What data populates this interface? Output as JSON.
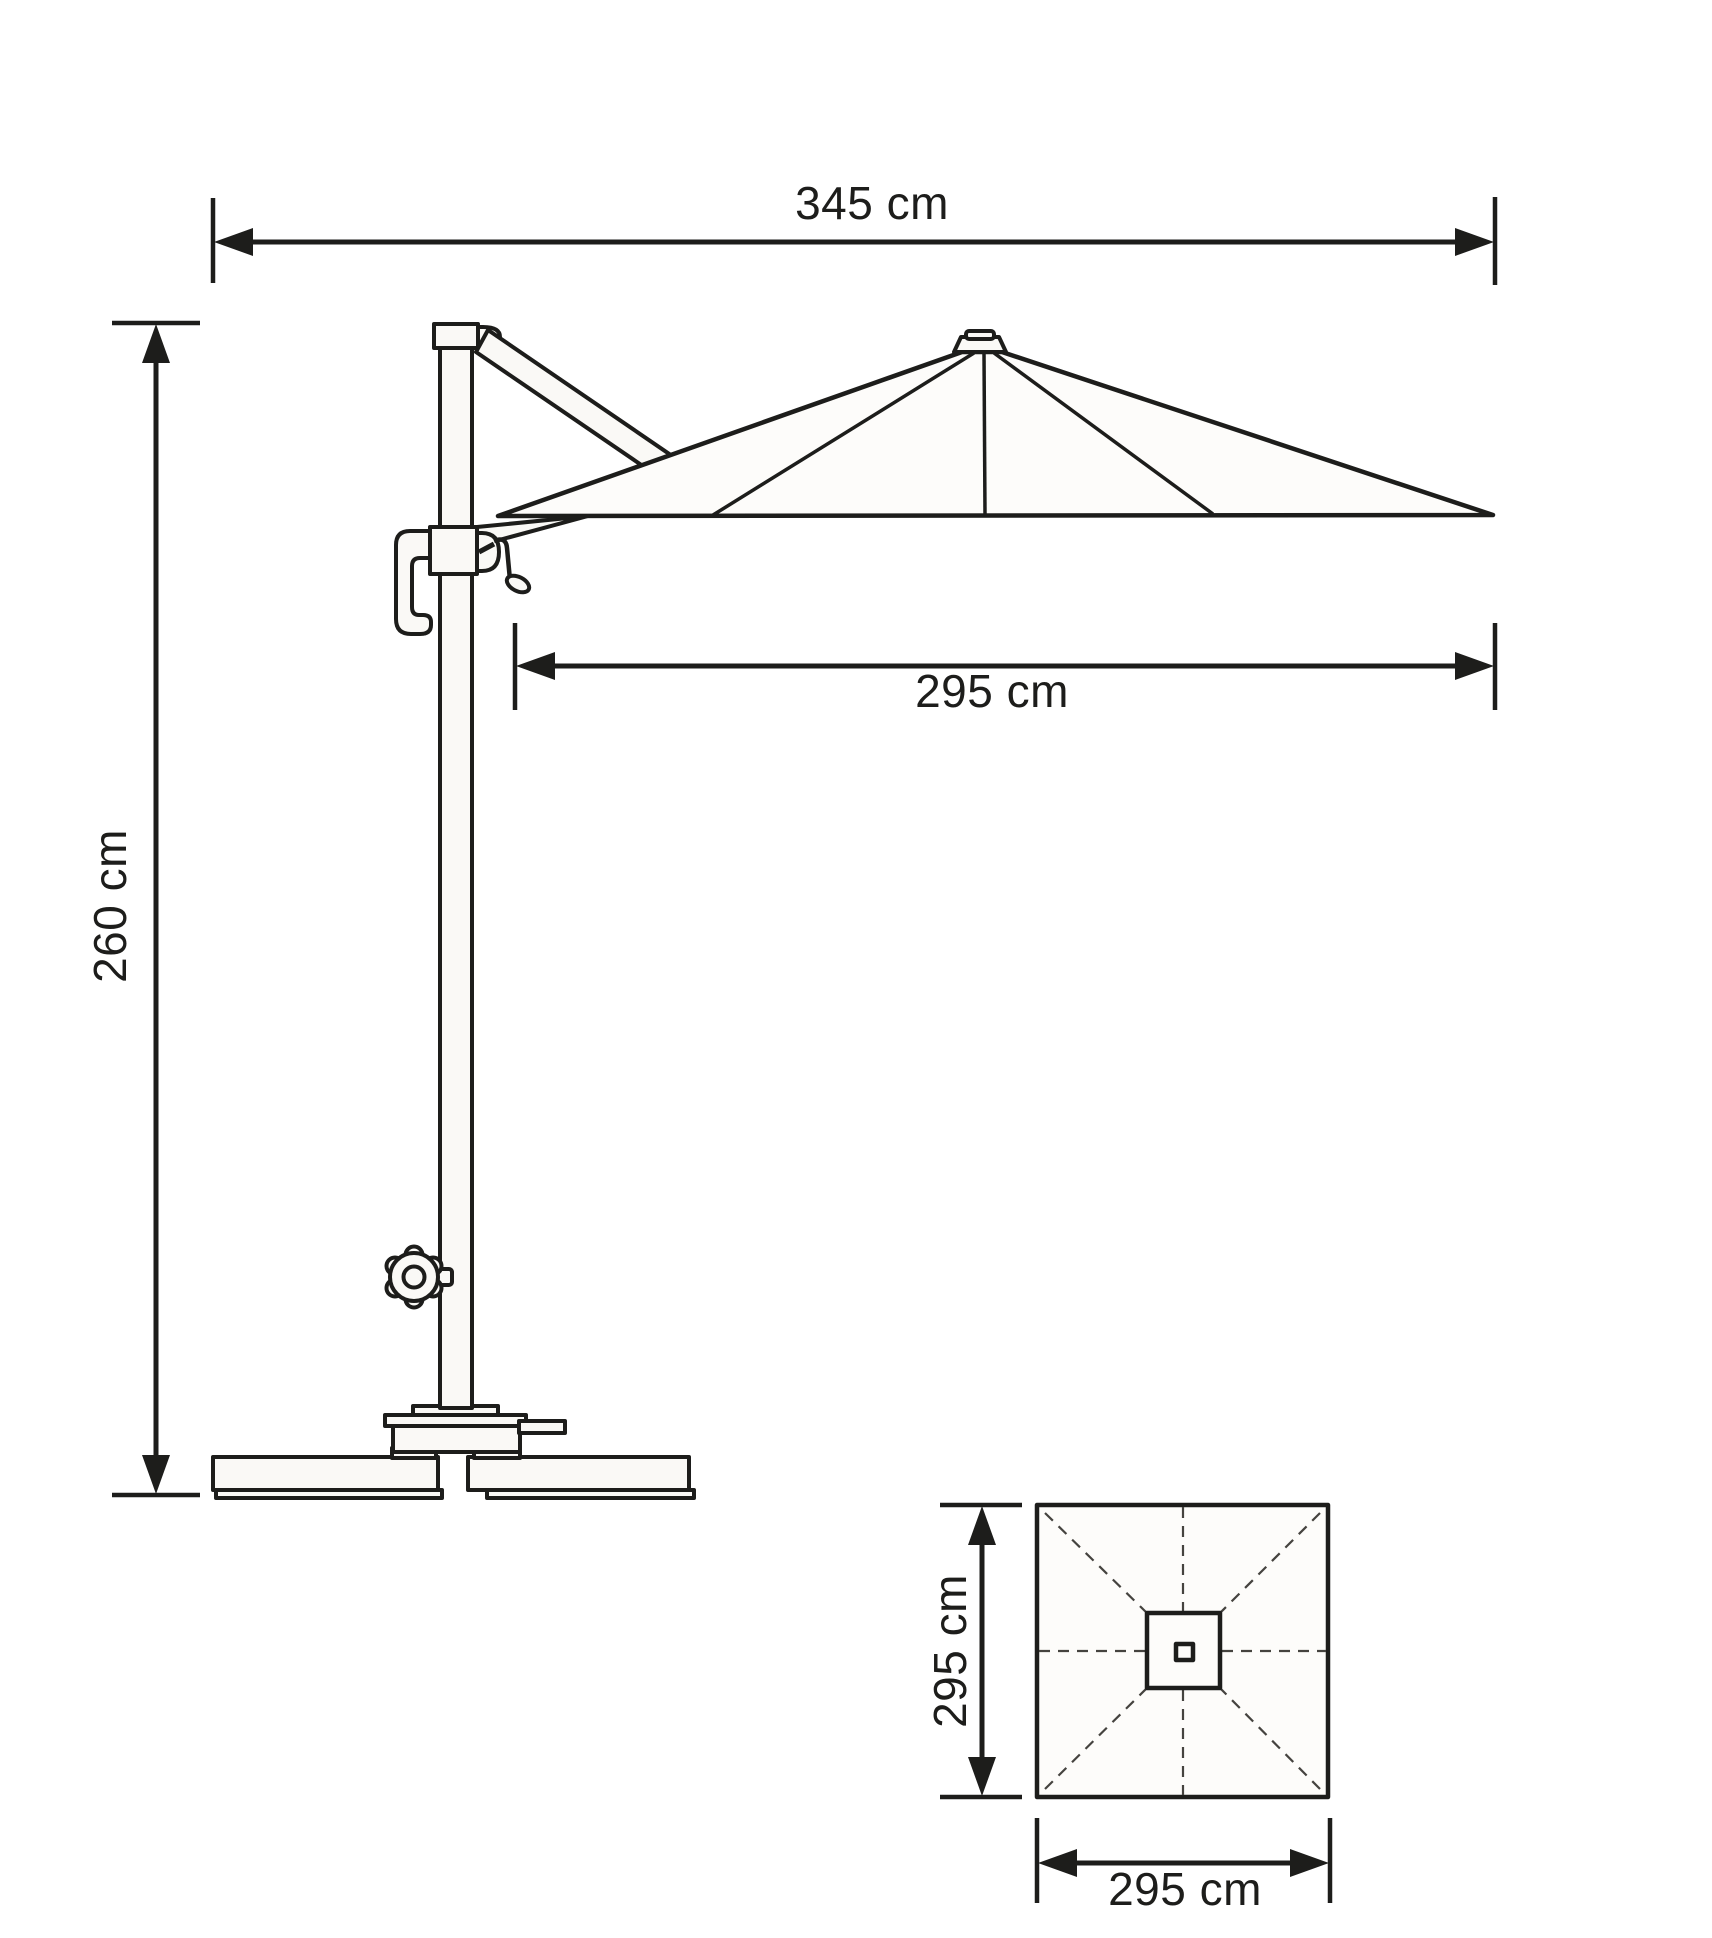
{
  "diagram": {
    "kind": "technical dimension drawing",
    "subject": "cantilever patio umbrella — side elevation and canopy top view",
    "colors": {
      "line": "#1d1d1b",
      "part_fill": "#faf9f6",
      "canopy_fill": "#fdfcfa",
      "dash_line": "#45433f",
      "background": "#ffffff"
    },
    "side_view": {
      "overall_width_label": "345 cm",
      "height_label": "260 cm",
      "canopy_width_label": "295 cm",
      "parts": [
        "canopy",
        "finial",
        "cantilever-arm",
        "pole",
        "pole-cap",
        "crank-housing",
        "crank-handle",
        "hand-grip-hook",
        "tilt-knob",
        "base-turntable",
        "base-pedal",
        "base-weight-slabs"
      ]
    },
    "top_view": {
      "depth_label": "295 cm",
      "width_label": "295 cm",
      "parts": [
        "square-canopy-outline",
        "hub-plate",
        "pole-section",
        "dashed-ribs"
      ]
    }
  }
}
